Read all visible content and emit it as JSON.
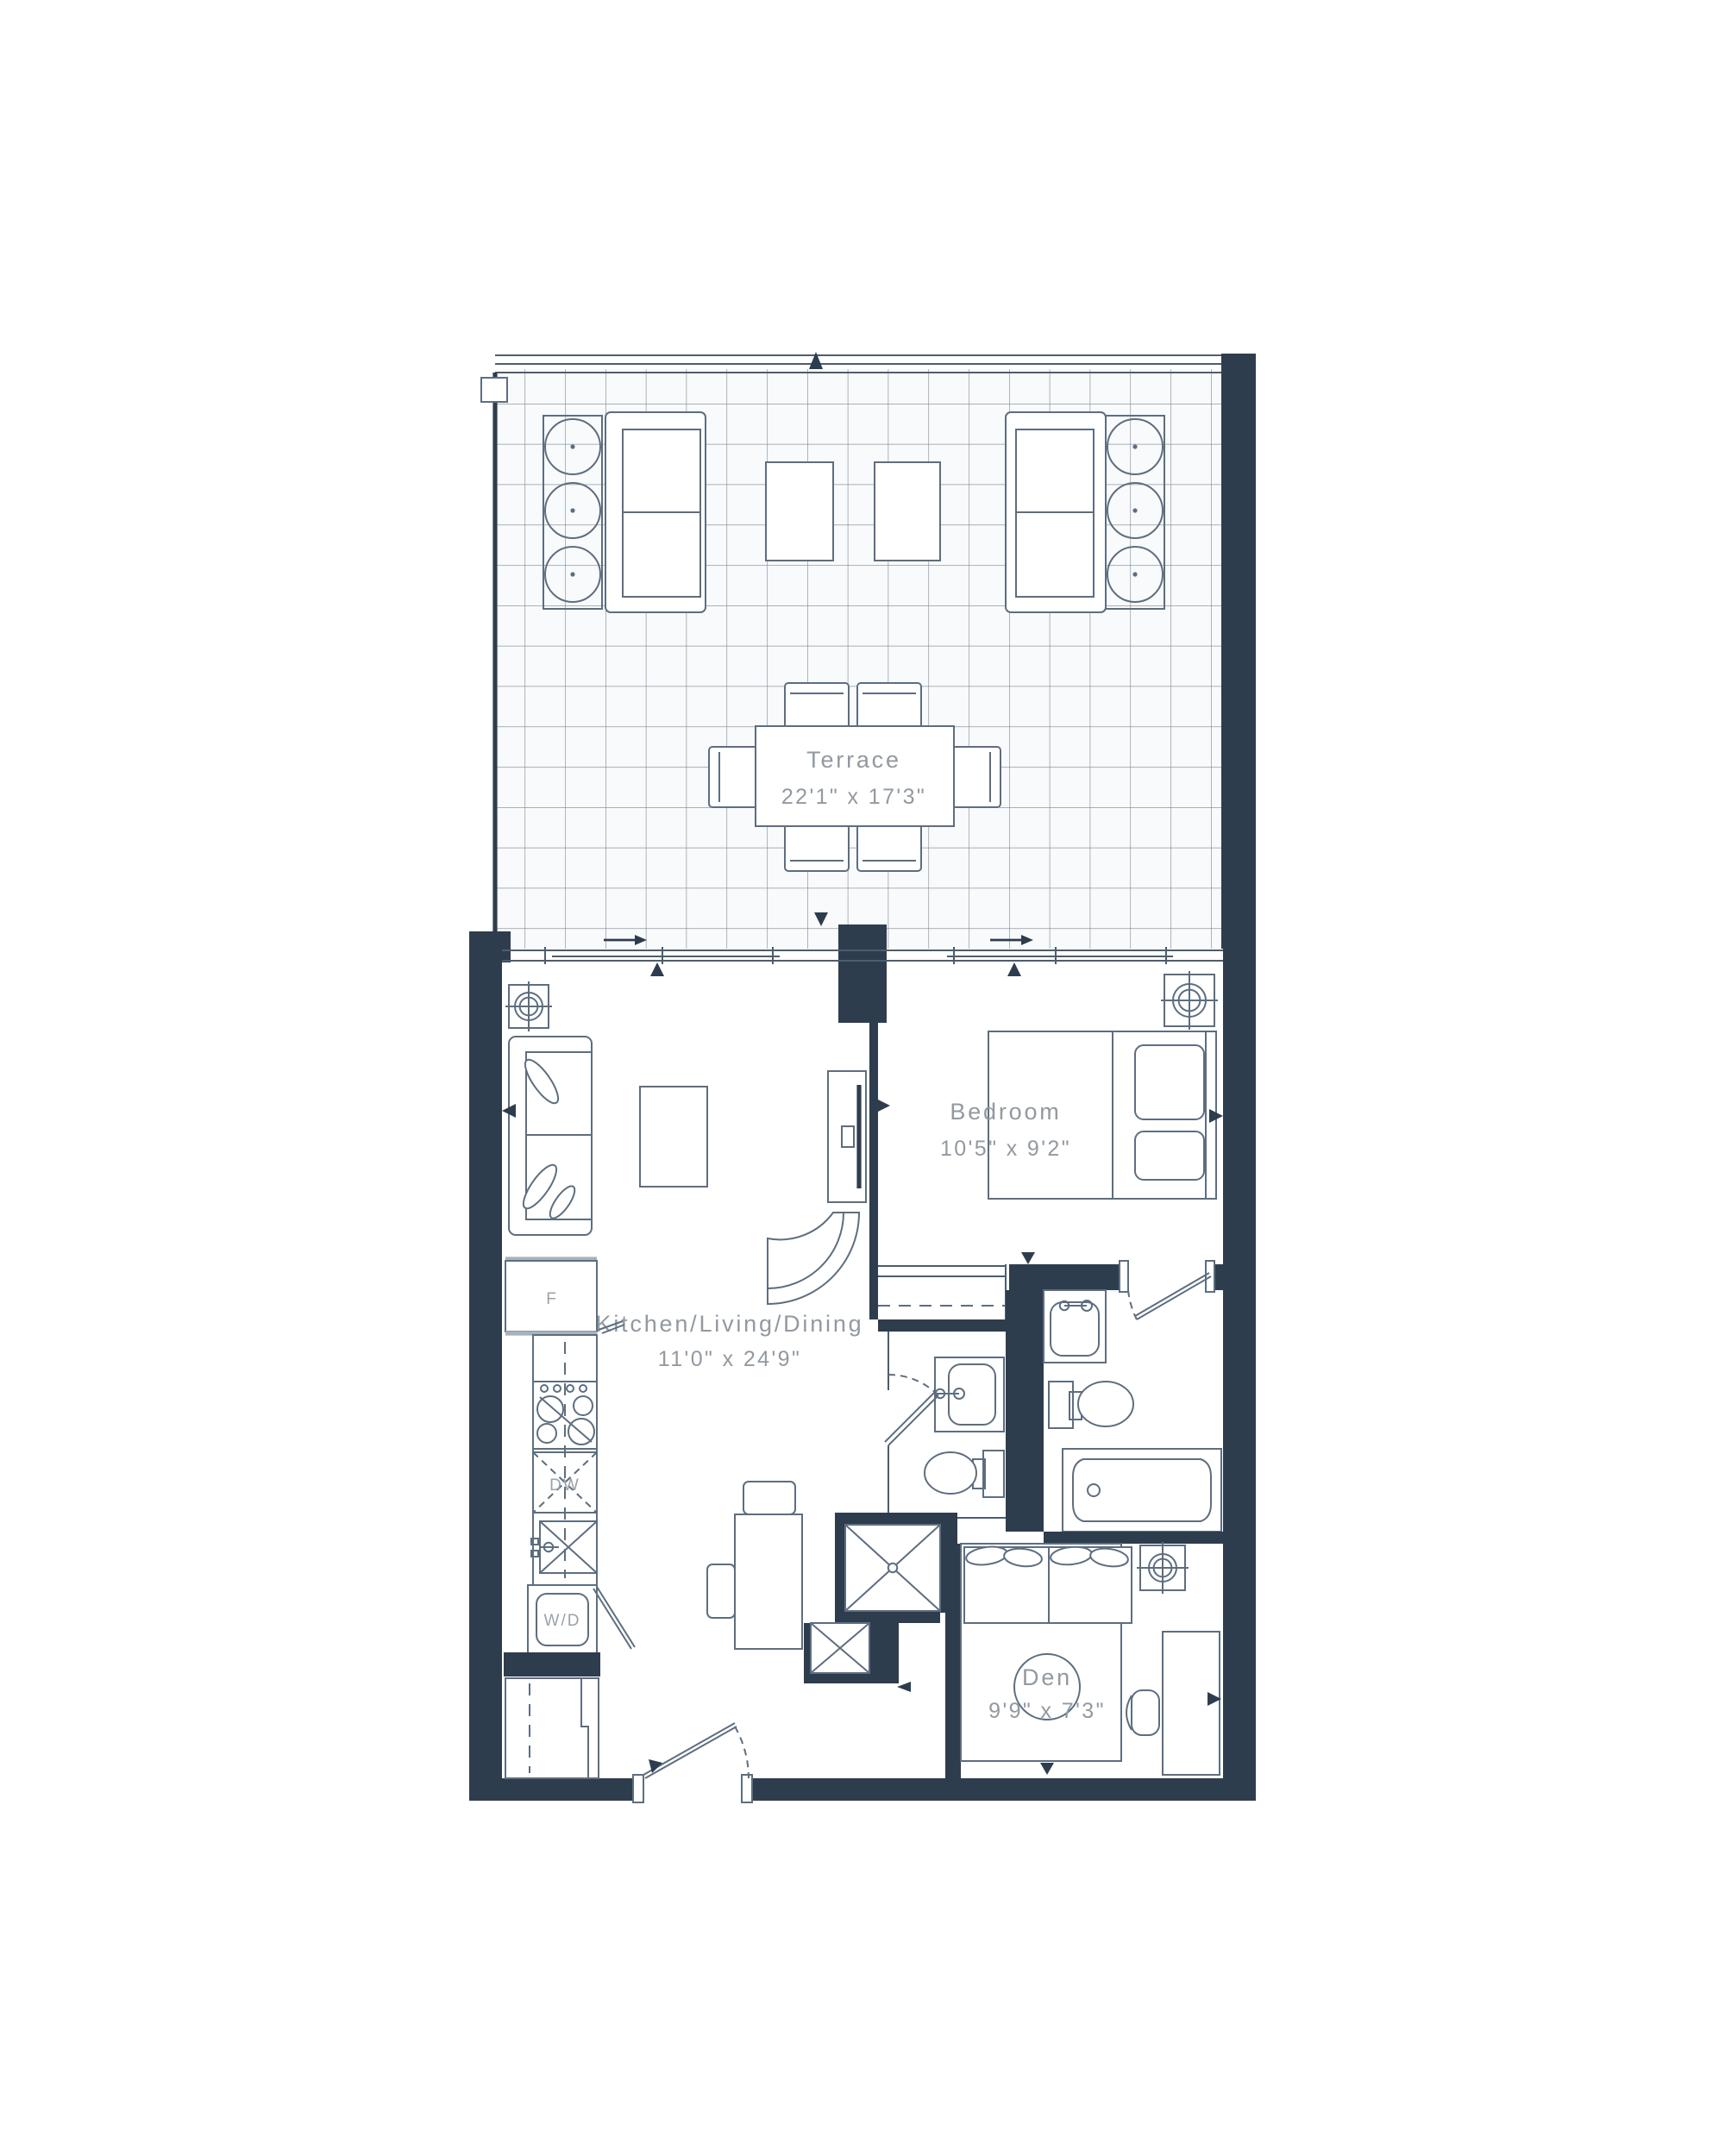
{
  "plan": {
    "type": "residential-floor-plan",
    "rooms": [
      {
        "id": "terrace",
        "label": "Terrace",
        "dimensions": "22'1\" x 17'3\""
      },
      {
        "id": "bedroom",
        "label": "Bedroom",
        "dimensions": "10'5\" x 9'2\""
      },
      {
        "id": "kitchen-living-dining",
        "label": "Kitchen/Living/Dining",
        "dimensions": "11'0\" x 24'9\""
      },
      {
        "id": "den",
        "label": "Den",
        "dimensions": "9'9\" x 7'3\""
      }
    ],
    "appliance_labels": {
      "fridge": "F",
      "dishwasher": "DW",
      "washer_dryer": "W/D"
    },
    "colors": {
      "wall": "#2e3d4e",
      "line": "#4c5d6f",
      "furniture_line": "#5d6e7f",
      "label_text": "#9299a1",
      "tile_background": "#f9fafc",
      "page_background": "#ffffff"
    }
  }
}
